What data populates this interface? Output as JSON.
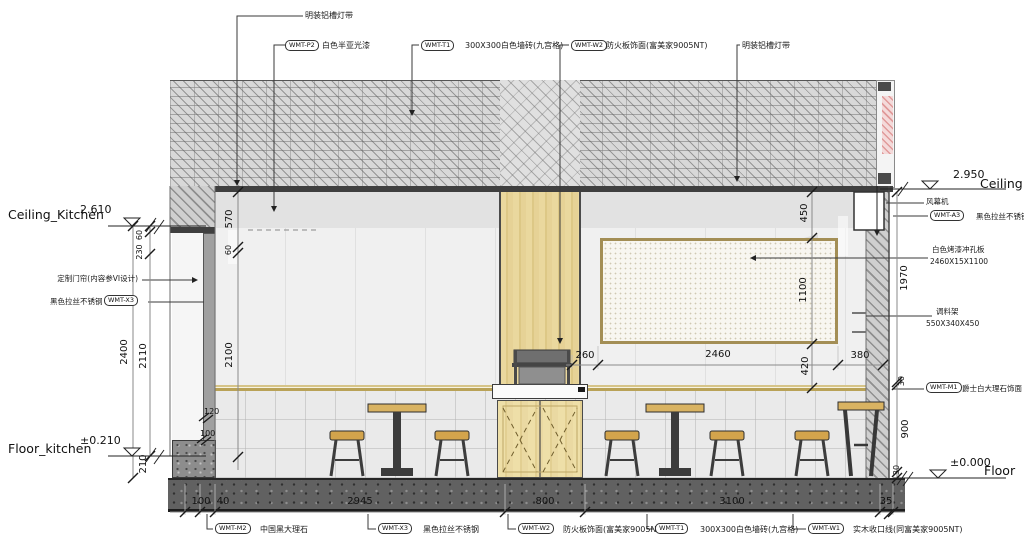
{
  "drawing": {
    "callouts_top": [
      {
        "tag": "",
        "text": "明装铝槽灯带"
      },
      {
        "tag": "WMT-P2",
        "text": "白色半亚光漆"
      },
      {
        "tag": "WMT-T1",
        "text": "300X300白色墙砖(九宫格)"
      },
      {
        "tag": "WMT-W2",
        "text": "防火板饰面(富美家9005NT)"
      },
      {
        "tag": "",
        "text": "明装铝槽灯带"
      }
    ],
    "callouts_bottom": [
      {
        "tag": "WMT-M2",
        "text": "中国黑大理石"
      },
      {
        "tag": "WMT-X3",
        "text": "黑色拉丝不锈钢"
      },
      {
        "tag": "WMT-W2",
        "text": "防火板饰面(富美家9005NT)"
      },
      {
        "tag": "WMT-T1",
        "text": "300X300白色墙砖(九宫格)"
      },
      {
        "tag": "WMT-W1",
        "text": "实木收口线(同富美家9005NT)"
      }
    ],
    "callouts_left": {
      "curtain": "定制门帘(内容参VI设计)",
      "steel_text": "黑色拉丝不锈钢",
      "steel_tag": "WMT-X3"
    },
    "callouts_right": {
      "air_curtain": "风幕机",
      "steel_tag": "WMT-A3",
      "steel_text": "黑色拉丝不锈钢",
      "panel_line1": "白色烤漆冲孔板",
      "panel_line2": "2460X15X1100",
      "rack_line1": "调料架",
      "rack_line2": "550X340X450",
      "marble_tag": "WMT-M1",
      "marble_text": "爵士白大理石饰面"
    },
    "levels": {
      "ceiling_kitchen_label": "Ceiling_Kitchen",
      "ceiling_kitchen_value": "2.610",
      "floor_kitchen_label": "Floor_kitchen",
      "floor_kitchen_value": "±0.210",
      "ceiling_label": "Ceiling",
      "ceiling_value": "2.950",
      "floor_label": "Floor",
      "floor_value": "±0.000"
    },
    "dims": {
      "bottom": [
        "100",
        "40",
        "2945",
        "800",
        "3100",
        "35"
      ],
      "mid": [
        "260",
        "2460",
        "380"
      ],
      "left_60": "60",
      "left_230": "230",
      "left_2400": "2400",
      "left_2110": "2110",
      "left_570": "570",
      "left_60b": "60",
      "left_2100": "2100",
      "left_210": "210",
      "left_120": "120",
      "left_100": "100",
      "right_450": "450",
      "right_1100": "1100",
      "right_420": "420",
      "right_1970": "1970",
      "right_30a": "30",
      "right_900": "900",
      "right_30b": "30"
    },
    "colors": {
      "wood_accent": "#e6d296",
      "gold_trim": "#b9a257",
      "floor_dark": "#616161",
      "panel_border": "#a38e55",
      "stool_seat": "#d3a44c"
    }
  }
}
